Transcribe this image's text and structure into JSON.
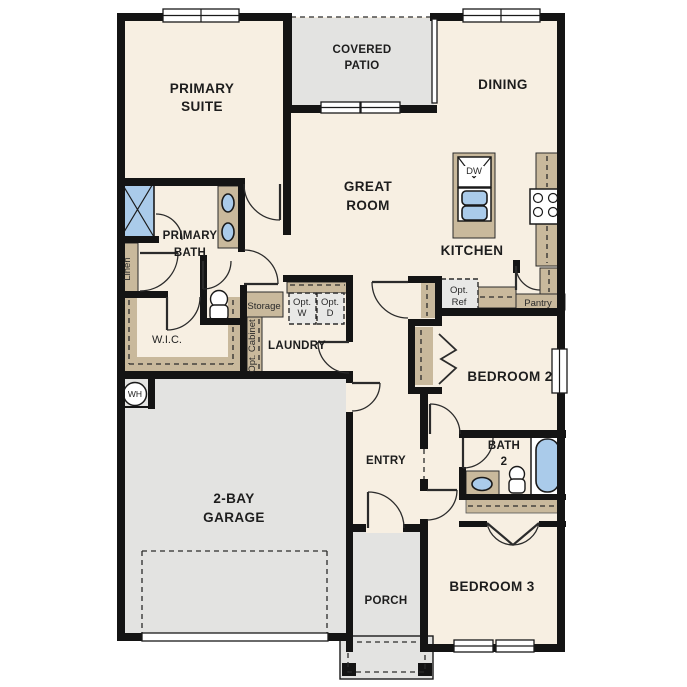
{
  "plan": {
    "colors": {
      "floor": "#f7efe2",
      "hard": "#e3e3e1",
      "cabinet": "#c9b99c",
      "fixture_blue": "#aacbea",
      "wall": "#141414"
    },
    "rooms": {
      "primary_suite1": "PRIMARY",
      "primary_suite2": "SUITE",
      "covered_patio1": "COVERED",
      "covered_patio2": "PATIO",
      "dining": "DINING",
      "great1": "GREAT",
      "great2": "ROOM",
      "kitchen": "KITCHEN",
      "primary_bath1": "PRIMARY",
      "primary_bath2": "BATH",
      "wic": "W.I.C.",
      "laundry": "LAUNDRY",
      "garage1": "2-BAY",
      "garage2": "GARAGE",
      "entry": "ENTRY",
      "porch": "PORCH",
      "bedroom2": "BEDROOM 2",
      "bath2_1": "BATH",
      "bath2_2": "2",
      "bedroom3": "BEDROOM 3"
    },
    "fixtures": {
      "linen": "Linen",
      "storage": "Storage",
      "opt_cabinet": "Opt. Cabinet",
      "opt_w1": "Opt.",
      "opt_w2": "W",
      "opt_d1": "Opt.",
      "opt_d2": "D",
      "opt_ref1": "Opt.",
      "opt_ref2": "Ref",
      "pantry": "Pantry",
      "dw": "DW",
      "wh": "WH"
    }
  }
}
